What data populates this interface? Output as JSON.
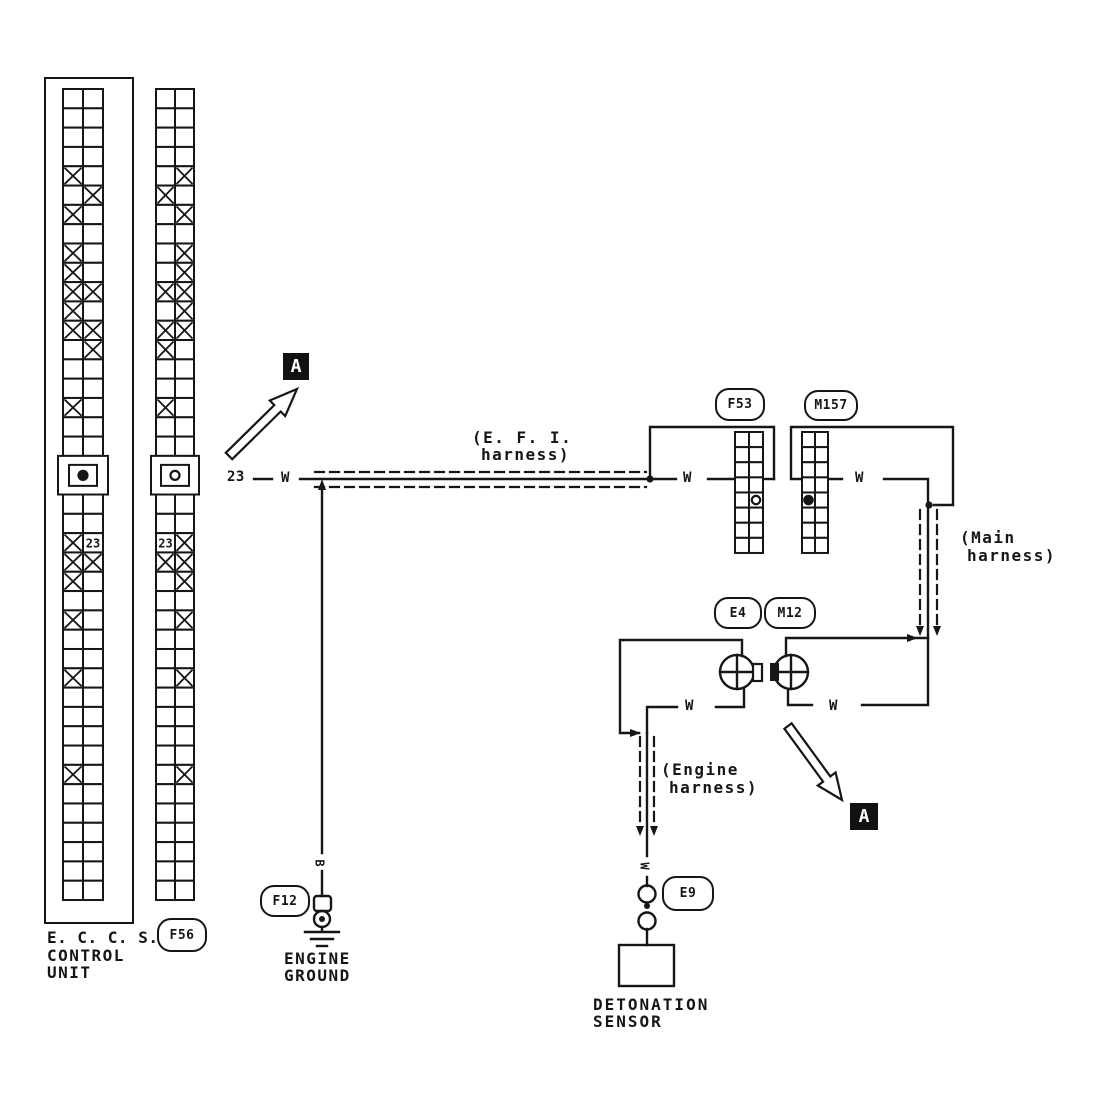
{
  "colors": {
    "ink": "#161616",
    "paper": "#ffffff"
  },
  "labels": {
    "eccs": [
      "E. C. C. S.",
      "CONTROL",
      "UNIT"
    ],
    "engine_ground": [
      "ENGINE",
      "GROUND"
    ],
    "detonation_sensor": [
      "DETONATION",
      "SENSOR"
    ],
    "efi_harness": [
      "(E. F. I.",
      "harness)"
    ],
    "main_harness": [
      "(Main",
      "harness)"
    ],
    "engine_harness": [
      "(Engine",
      "harness)"
    ],
    "section_marker": "A",
    "pin_number": "23",
    "wire_color_white": "W",
    "wire_color_black": "B"
  },
  "connectors": {
    "f56": "F56",
    "f53": "F53",
    "m157": "M157",
    "e4": "E4",
    "m12": "M12",
    "f12": "F12",
    "e9": "E9"
  },
  "grids": {
    "eccs_left": {
      "rows": 42,
      "cols": 2,
      "x_cells": {
        "5": "L",
        "6": "R",
        "7": "L",
        "9": "L",
        "10": "L",
        "11": "LR",
        "12": "L",
        "13": "LR",
        "14": "R",
        "17": "L",
        "24": "L",
        "25": "LR",
        "26": "L",
        "28": "L",
        "31": "L",
        "36": "L"
      },
      "pin_label": {
        "row": 24,
        "col": "R",
        "text": "23"
      },
      "keyway": {
        "from": 20,
        "to": 21,
        "symbol": "filled-dot"
      },
      "section_break_rows": [
        9,
        27
      ]
    },
    "f56": {
      "rows": 42,
      "cols": 2,
      "x_cells": {
        "5": "R",
        "6": "L",
        "7": "R",
        "9": "R",
        "10": "R",
        "11": "LR",
        "12": "R",
        "13": "LR",
        "14": "L",
        "17": "L",
        "24": "R",
        "25": "LR",
        "26": "R",
        "28": "R",
        "31": "R",
        "36": "R"
      },
      "pin_label": {
        "row": 24,
        "col": "L",
        "text": "23"
      },
      "keyway": {
        "from": 20,
        "to": 21,
        "symbol": "hollow-ring"
      },
      "section_break_rows": [
        9,
        27
      ]
    },
    "f53": {
      "rows": 8,
      "cols": 2,
      "x_cells": {},
      "terminal_dot": {
        "row": 5,
        "col": "R",
        "style": "hollow"
      }
    },
    "m157": {
      "rows": 8,
      "cols": 2,
      "x_cells": {},
      "terminal_dot": {
        "row": 5,
        "col": "L",
        "style": "filled"
      }
    }
  }
}
